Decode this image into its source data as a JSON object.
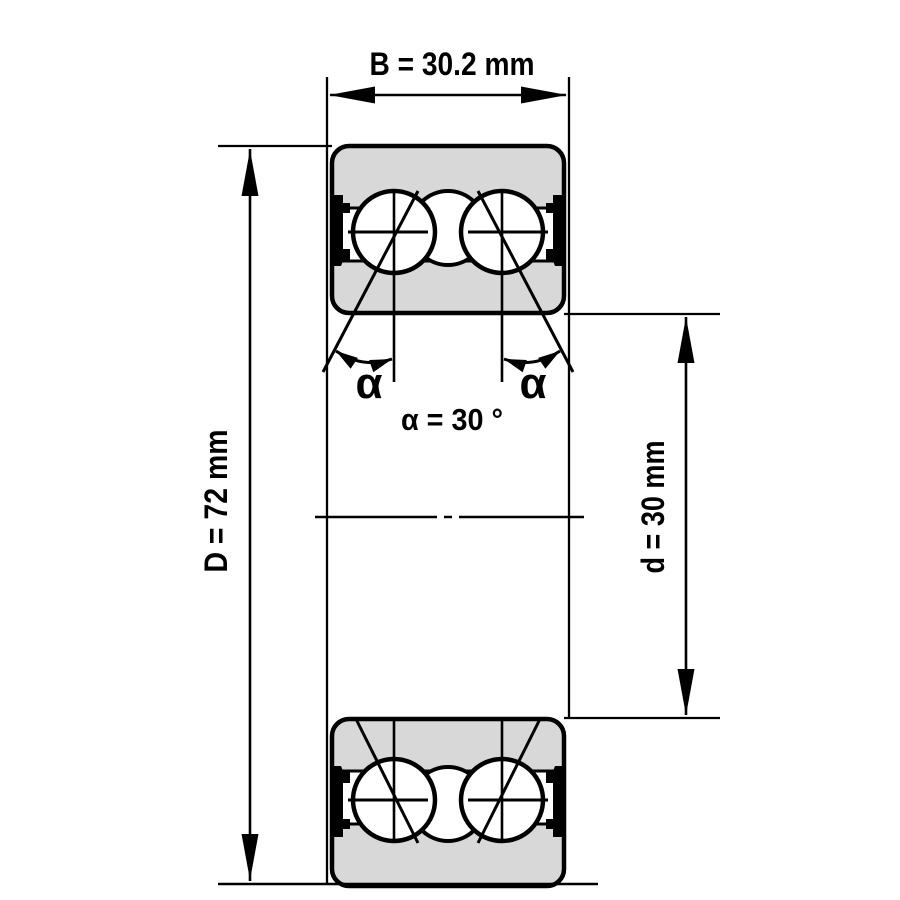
{
  "drawing": {
    "kind": "double-row angular contact ball bearing cross-section",
    "labels": {
      "width": "B = 30.2 mm",
      "outer_diameter": "D = 72 mm",
      "bore_diameter": "d = 30 mm",
      "contact_angle": "α = 30 °",
      "angle_symbol_left": "α",
      "angle_symbol_right": "α"
    },
    "colors": {
      "line": "#000000",
      "ring_fill": "#d8d8d8",
      "background": "#ffffff"
    }
  }
}
